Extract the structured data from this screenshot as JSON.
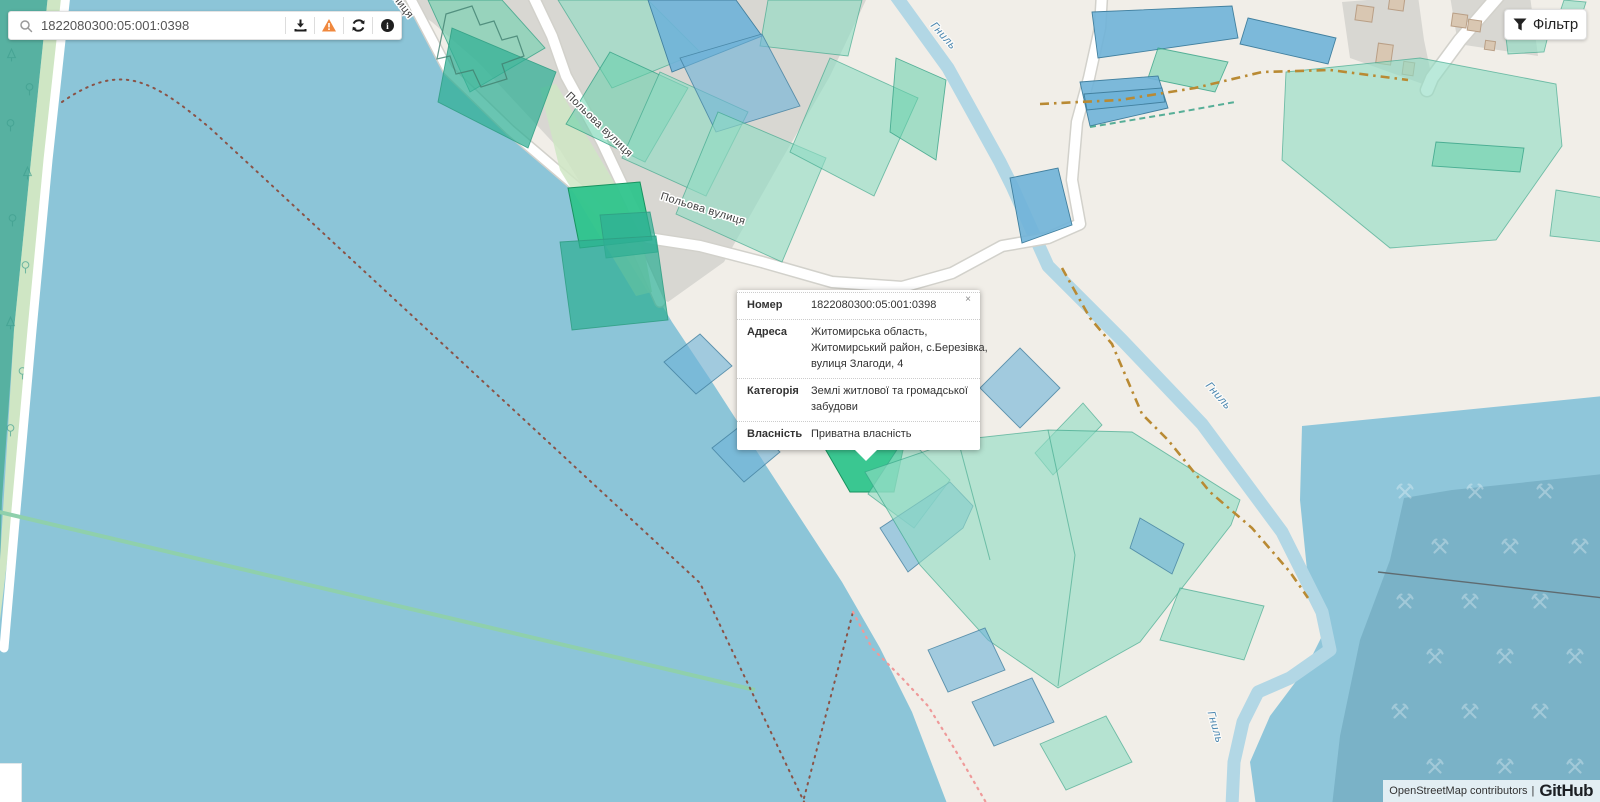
{
  "search": {
    "value": "1822080300:05:001:0398",
    "icons": [
      "magnifier-icon",
      "download-icon",
      "warning-icon",
      "refresh-icon",
      "info-icon"
    ]
  },
  "filter_button": {
    "label": "Фільтр"
  },
  "popup": {
    "close_label": "×",
    "rows": [
      {
        "label": "Номер",
        "lines": [
          "1822080300:05:001:0398"
        ]
      },
      {
        "label": "Адреса",
        "lines": [
          "Житомирська область,",
          "Житомирський район, с.Березівка,",
          "вулиця Злагоди, 4"
        ]
      },
      {
        "label": "Категорія",
        "lines": [
          "Землі житлової та громадської",
          "забудови"
        ]
      },
      {
        "label": "Власність",
        "lines": [
          "Приватна власність"
        ]
      }
    ]
  },
  "map_labels": {
    "streets": [
      "Польова вулиця",
      "Польова вулиця"
    ],
    "street_fragment": "вулиця",
    "rivers": [
      "Гниль",
      "Гниль",
      "Гниль"
    ]
  },
  "attribution": {
    "osm": "OpenStreetMap contributors",
    "separator": "|",
    "brand": "GitHub"
  },
  "colors": {
    "water": "#8cc5d8",
    "land": "#f1eee8",
    "residential": "#d8d7d2",
    "forest": "#57b1a1",
    "forest_tree": "#3f9e8e",
    "shore_green": "#cfe6c4",
    "road": "#ffffff",
    "road_casing": "#d2d1cb",
    "river": "#b2d7e5",
    "river_label": "#4b87b0",
    "street_label": "#3e3e3e",
    "parcel_teal": "#63cfa9",
    "parcel_teal_light": "#8fdcc3",
    "parcel_teal_dark": "#2fae94",
    "parcel_selected": "#2fc48c",
    "parcel_selected_stroke": "#17935f",
    "parcel_stroke": "#2f9e82",
    "parcel_blue": "#6fb3d8",
    "parcel_blue_stroke": "#42809f",
    "track": "#b98a33",
    "boundary_dot": "#8a5347",
    "boundary_pink": "#ef9a9a",
    "stream": "#8fd0ac",
    "quarry": "#7ab2c7",
    "quarry_light": "#8fc6da",
    "quarry_line": "#5f6b70",
    "building": "#d9c7b2",
    "building_stroke": "#b99f86",
    "warning": "#f0883e",
    "icon_dark": "#1f1f1f",
    "popup_text": "#333333"
  }
}
